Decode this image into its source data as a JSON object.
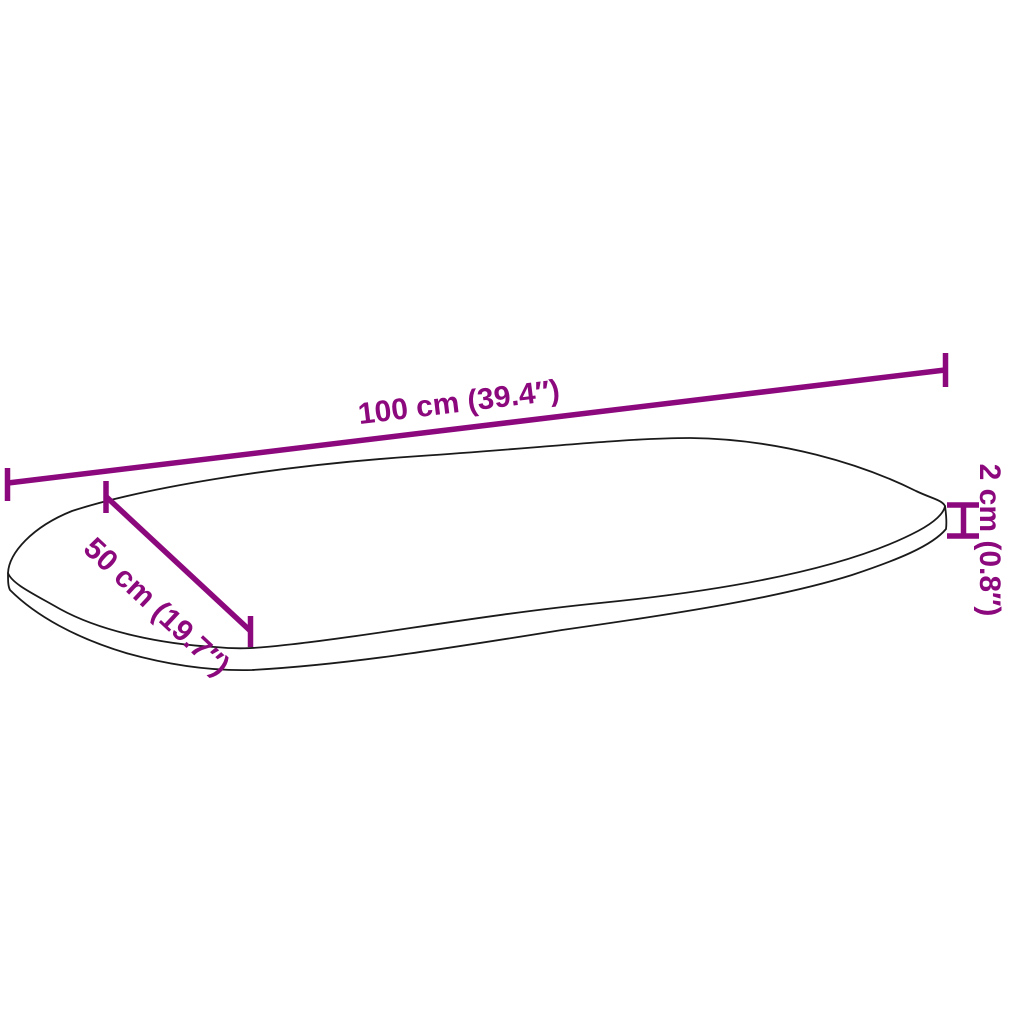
{
  "page": {
    "background_color": "#FFFFFF",
    "accent_color": "#8C087D",
    "outline_color": "#1A1A1A"
  },
  "diagram": {
    "subject": "oval-tabletop-dimension-drawing",
    "dimensions": {
      "length": {
        "value_cm": 100,
        "value_in": 39.4,
        "label": "100 cm (39.4″)"
      },
      "width": {
        "value_cm": 50,
        "value_in": 19.7,
        "label": "50 cm (19.7″)"
      },
      "thickness": {
        "value_cm": 2,
        "value_in": 0.8,
        "label": "2 cm (0.8″)"
      }
    }
  }
}
